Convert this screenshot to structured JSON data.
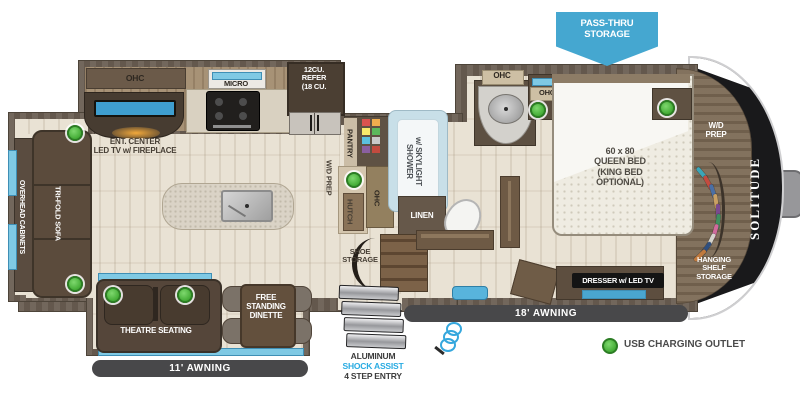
{
  "floorplan": {
    "brand_logo": "SOLITUDE",
    "callout_pass_thru": "PASS-THRU\nSTORAGE",
    "awning_left": "11' AWNING",
    "awning_right": "18' AWNING",
    "entry_line1": "ALUMINUM",
    "entry_line2": "SHOCK ASSIST",
    "entry_line3": "4 STEP ENTRY",
    "legend_usb": "USB CHARGING OUTLET",
    "rooms": {
      "overhead_cabinets": "OVERHEAD CABINETS",
      "tri_fold_sofa": "TRI-FOLD SOFA",
      "theatre_seating": "THEATRE SEATING",
      "free_standing_dinette": "FREE\nSTANDING\nDINETTE",
      "ohc_kitchen": "OHC",
      "micro": "MICRO",
      "refer": "12CU.\nREFER\n(18 CU.",
      "ent_center": "ENT. CENTER\nLED TV w/ FIREPLACE",
      "pantry": "PANTRY",
      "wd_prep_mid": "W/D PREP",
      "hutch": "HUTCH",
      "ohc_mid": "OHC",
      "shower": "SHOWER\nw/ SKYLIGHT",
      "linen": "LINEN",
      "shoe_storage": "SHOE\nSTORAGE",
      "ohc_bath_1": "OHC",
      "ohc_bath_2": "OHC",
      "queen_bed": "60 x 80\nQUEEN BED\n(KING BED\nOPTIONAL)",
      "dresser_tv": "DRESSER w/ LED TV",
      "wd_prep_front": "W/D\nPREP",
      "hanging_shelf_storage": "HANGING\nSHELF\nSTORAGE"
    },
    "colors": {
      "accent_blue": "#29abe2",
      "window_blue": "#7fc9e4",
      "usb_green": "#45ad37",
      "callout_blue": "#45a7d0",
      "awning_bar": "#48484a",
      "wall_brown": "#6b5f53"
    }
  }
}
